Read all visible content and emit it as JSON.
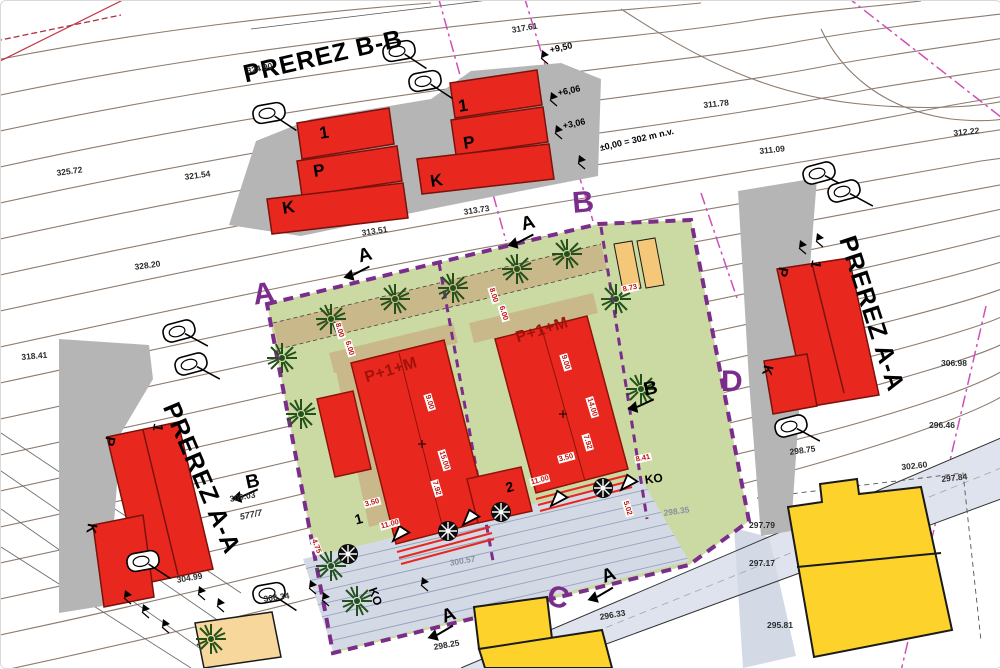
{
  "sections": {
    "bb_title": "PREREZ B-B",
    "aa_left_title": "PREREZ A-A",
    "aa_right_title": "PREREZ A-A"
  },
  "floors": {
    "first": "1",
    "ground": "P",
    "basement": "K"
  },
  "buildings": {
    "type_label_1": "P+1+M",
    "type_label_2": "P+1+M"
  },
  "boundary_corners": {
    "a": "A",
    "b": "B",
    "c": "C",
    "d": "D"
  },
  "section_cut_markers": {
    "a": "A",
    "b": "B"
  },
  "annotations": {
    "ko_1": "KO",
    "ko_2": "KO",
    "plot_1": "1",
    "plot_2": "2",
    "parcel_number": "577/7",
    "datum_note": "±0,00 = 302 m n.v."
  },
  "level_marks": [
    "+9,50",
    "+6,06",
    "+3,06"
  ],
  "elevations": [
    "324.90",
    "317.61",
    "325.72",
    "321.54",
    "328.20",
    "318.41",
    "313.73",
    "313.51",
    "311.78",
    "312.22",
    "311.09",
    "306.98",
    "296.46",
    "298.75",
    "302.60",
    "297.84",
    "297.79",
    "297.17",
    "295.81",
    "298.25",
    "300.57",
    "298.35",
    "300.03",
    "304.99",
    "306.34",
    "296.33"
  ],
  "dimensions": [
    "9.00",
    "15.00",
    "7.92",
    "3.50",
    "11.00",
    "4.75",
    "9.00",
    "14.00",
    "7.92",
    "3.50",
    "11.00",
    "8.41",
    "8.73",
    "5.02",
    "8.00",
    "6.00",
    "8.00",
    "6.00"
  ],
  "colors": {
    "boundary_purple": "#7b2d8b",
    "building_red": "#e8281e",
    "existing_yellow": "#fdd32b",
    "lawn_green": "#cbd9a2",
    "path_tan": "#c9b98a",
    "terrain_gray": "#b5b5b5",
    "contour_brown": "#8d7b6e",
    "parcel_magenta": "#cf4fb8",
    "paving_blue": "#d3dae6"
  }
}
